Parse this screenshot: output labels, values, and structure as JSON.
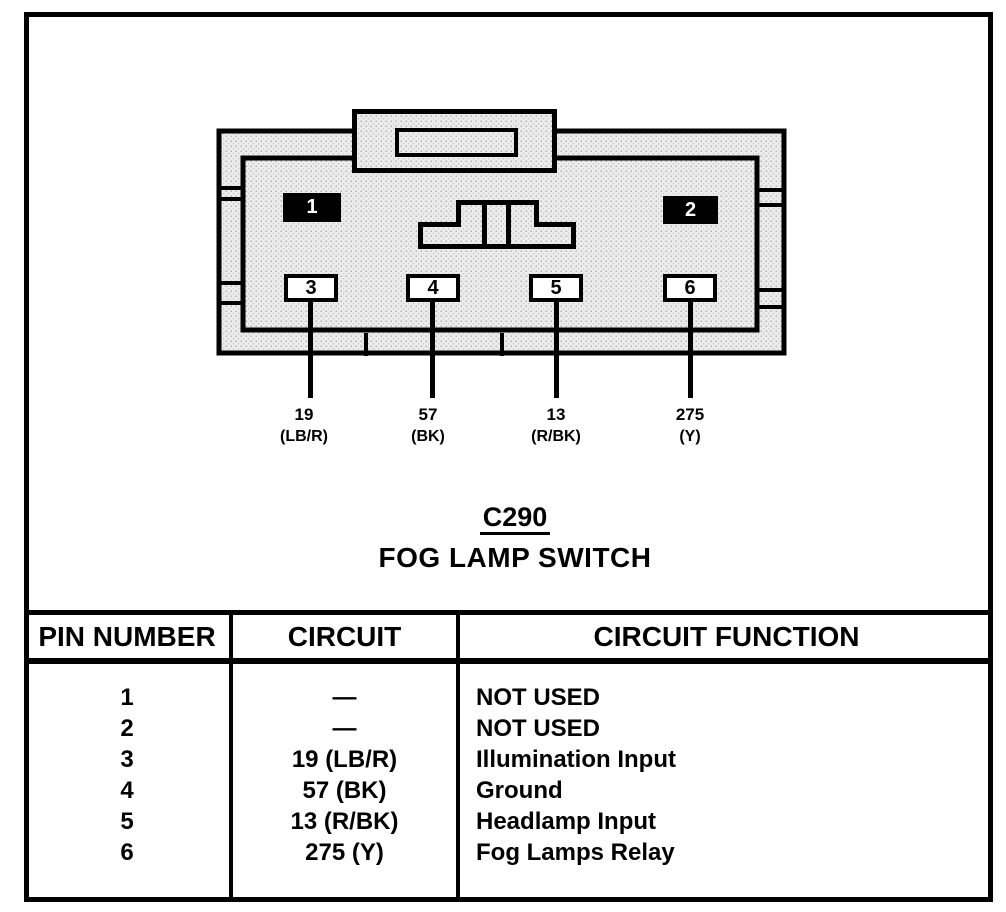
{
  "colors": {
    "ink": "#000000",
    "paper": "#ffffff",
    "connector_fill": "#e9e9e9"
  },
  "connector": {
    "id": "C290",
    "name": "FOG LAMP SWITCH",
    "pins": [
      {
        "number": "1",
        "style": "filled"
      },
      {
        "number": "2",
        "style": "filled"
      },
      {
        "number": "3",
        "style": "open"
      },
      {
        "number": "4",
        "style": "open"
      },
      {
        "number": "5",
        "style": "open"
      },
      {
        "number": "6",
        "style": "open"
      }
    ],
    "wires": [
      {
        "circuit": "19",
        "color_code": "(LB/R)"
      },
      {
        "circuit": "57",
        "color_code": "(BK)"
      },
      {
        "circuit": "13",
        "color_code": "(R/BK)"
      },
      {
        "circuit": "275",
        "color_code": "(Y)"
      }
    ]
  },
  "table": {
    "headers": [
      "PIN NUMBER",
      "CIRCUIT",
      "CIRCUIT FUNCTION"
    ],
    "rows": [
      {
        "pin": "1",
        "circuit": "—",
        "function": "NOT USED"
      },
      {
        "pin": "2",
        "circuit": "—",
        "function": "NOT USED"
      },
      {
        "pin": "3",
        "circuit": "19 (LB/R)",
        "function": "Illumination Input"
      },
      {
        "pin": "4",
        "circuit": "57 (BK)",
        "function": "Ground"
      },
      {
        "pin": "5",
        "circuit": "13 (R/BK)",
        "function": "Headlamp Input"
      },
      {
        "pin": "6",
        "circuit": "275 (Y)",
        "function": "Fog Lamps Relay"
      }
    ]
  }
}
